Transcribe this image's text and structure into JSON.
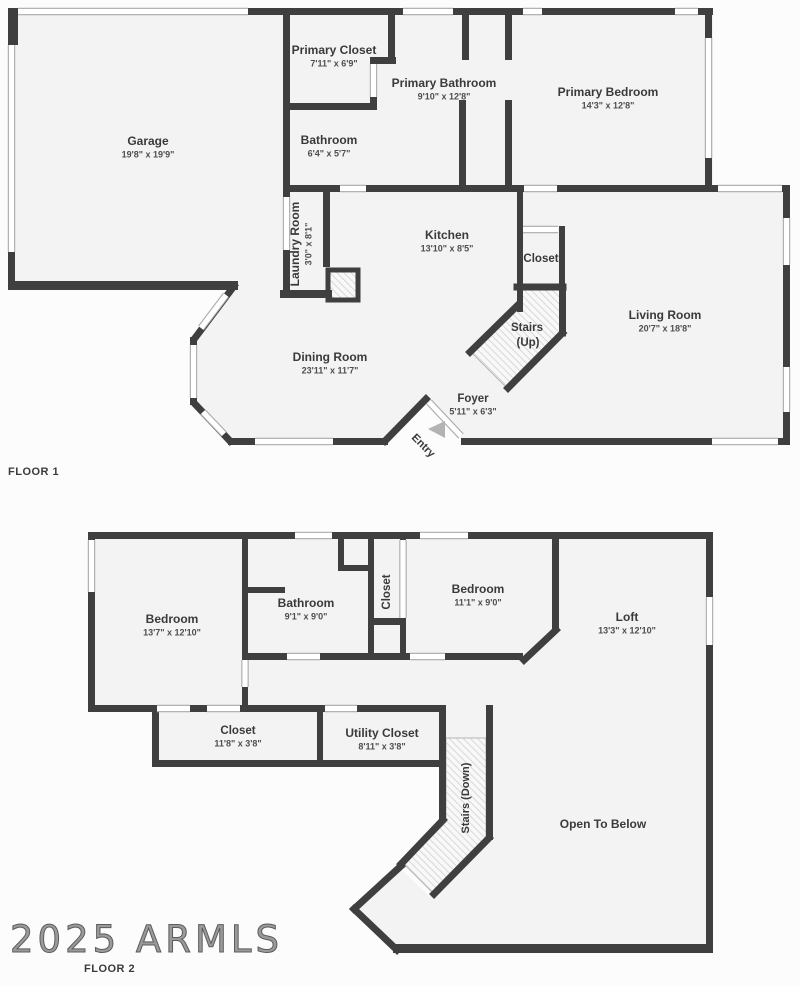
{
  "watermark": "2025 ARMLS",
  "colors": {
    "wall": "#3f3f3f",
    "room": "#f3f3f3",
    "bg": "#fcfcfc",
    "band_edge": "#a9a9a9",
    "band_fill": "#ffffff",
    "hatch_line": "#d0d0d0",
    "hatch_bg": "#f8f8f8",
    "text": "#3a3a3a",
    "dims": "#4e4e4e",
    "arrow": "#b3b3b3"
  },
  "floor1": {
    "label": "FLOOR 1",
    "rooms": [
      {
        "id": "garage",
        "name": "Garage",
        "dims": "19'8\" x 19'9\"",
        "x": 148,
        "y": 142
      },
      {
        "id": "primary-closet",
        "name": "Primary Closet",
        "dims": "7'11\" x 6'9\"",
        "x": 334,
        "y": 51
      },
      {
        "id": "primary-bathroom",
        "name": "Primary Bathroom",
        "dims": "9'10\" x 12'8\"",
        "x": 444,
        "y": 84
      },
      {
        "id": "primary-bedroom",
        "name": "Primary Bedroom",
        "dims": "14'3\" x 12'8\"",
        "x": 608,
        "y": 93
      },
      {
        "id": "bathroom-1",
        "name": "Bathroom",
        "dims": "6'4\" x 5'7\"",
        "x": 329,
        "y": 141
      },
      {
        "id": "laundry-room",
        "name": "Laundry Room",
        "dims": "3'0\" x 8'1\"",
        "x": 296,
        "y": 244,
        "rot": -90
      },
      {
        "id": "kitchen",
        "name": "Kitchen",
        "dims": "13'10\" x 8'5\"",
        "x": 447,
        "y": 236
      },
      {
        "id": "closet-f1",
        "name": "Closet",
        "x": 541,
        "y": 259,
        "fs": 11.5
      },
      {
        "id": "stairs-up",
        "name": "Stairs",
        "name2": "(Up)",
        "x": 527,
        "y": 328,
        "fs": 11.5
      },
      {
        "id": "living-room",
        "name": "Living Room",
        "dims": "20'7\" x 18'8\"",
        "x": 665,
        "y": 316
      },
      {
        "id": "dining-room",
        "name": "Dining Room",
        "dims": "23'11\" x 11'7\"",
        "x": 330,
        "y": 358
      },
      {
        "id": "foyer",
        "name": "Foyer",
        "dims": "5'11\" x 6'3\"",
        "x": 473,
        "y": 399,
        "fs": 11.5
      },
      {
        "id": "entry",
        "name": "Entry",
        "x": 423,
        "y": 446,
        "rot": 45,
        "fs": 11
      }
    ]
  },
  "floor2": {
    "label": "FLOOR 2",
    "rooms": [
      {
        "id": "bedroom-1",
        "name": "Bedroom",
        "dims": "13'7\" x 12'10\"",
        "x": 172,
        "y": 620
      },
      {
        "id": "bathroom-2",
        "name": "Bathroom",
        "dims": "9'1\" x 9'0\"",
        "x": 306,
        "y": 604
      },
      {
        "id": "closet-col",
        "name": "Closet",
        "x": 387,
        "y": 592,
        "rot": -90,
        "fs": 11.5
      },
      {
        "id": "bedroom-2",
        "name": "Bedroom",
        "dims": "11'1\" x 9'0\"",
        "x": 478,
        "y": 590
      },
      {
        "id": "loft",
        "name": "Loft",
        "dims": "13'3\" x 12'10\"",
        "x": 627,
        "y": 618
      },
      {
        "id": "closet-row",
        "name": "Closet",
        "dims": "11'8\" x 3'8\"",
        "x": 238,
        "y": 731,
        "fs": 11.5
      },
      {
        "id": "utility-closet",
        "name": "Utility Closet",
        "dims": "8'11\" x 3'8\"",
        "x": 382,
        "y": 734
      },
      {
        "id": "stairs-down",
        "name": "Stairs (Down)",
        "x": 466,
        "y": 798,
        "rot": -90,
        "fs": 11
      },
      {
        "id": "open-to-below",
        "name": "Open To Below",
        "x": 603,
        "y": 825
      }
    ]
  },
  "geometry": {
    "interiors": [
      {
        "pts": [
          [
            8,
            8
          ],
          [
            290,
            8
          ],
          [
            290,
            290
          ],
          [
            8,
            290
          ]
        ]
      },
      {
        "pts": [
          [
            283,
            8
          ],
          [
            713,
            8
          ],
          [
            713,
            192
          ],
          [
            283,
            192
          ]
        ]
      },
      {
        "pts": [
          [
            558,
            185
          ],
          [
            790,
            185
          ],
          [
            790,
            445
          ],
          [
            558,
            445
          ]
        ]
      },
      {
        "pts": [
          [
            280,
            185
          ],
          [
            558,
            185
          ],
          [
            558,
            441
          ],
          [
            463,
            441
          ],
          [
            426,
            400
          ],
          [
            385,
            441
          ],
          [
            231,
            441
          ],
          [
            196,
            404
          ],
          [
            193,
            339
          ],
          [
            236,
            285
          ],
          [
            280,
            285
          ]
        ]
      },
      {
        "pts": [
          [
            88,
            532
          ],
          [
            713,
            532
          ],
          [
            713,
            712
          ],
          [
            88,
            712
          ]
        ]
      },
      {
        "pts": [
          [
            152,
            705
          ],
          [
            446,
            705
          ],
          [
            446,
            767
          ],
          [
            152,
            767
          ]
        ]
      },
      {
        "pts": [
          [
            439,
            705
          ],
          [
            493,
            705
          ],
          [
            493,
            745
          ],
          [
            439,
            745
          ]
        ]
      },
      {
        "pts": [
          [
            493,
            712
          ],
          [
            713,
            712
          ],
          [
            713,
            946
          ],
          [
            398,
            946
          ],
          [
            355,
            909
          ],
          [
            400,
            868
          ],
          [
            430,
            897
          ],
          [
            487,
            841
          ],
          [
            493,
            834
          ]
        ]
      }
    ],
    "stairs": [
      {
        "pts": [
          [
            519,
            289
          ],
          [
            561,
            289
          ],
          [
            561,
            332
          ],
          [
            506,
            387
          ],
          [
            471,
            352
          ],
          [
            519,
            305
          ]
        ]
      },
      {
        "pts": [
          [
            446,
            738
          ],
          [
            486,
            738
          ],
          [
            486,
            838
          ],
          [
            432,
            892
          ],
          [
            404,
            864
          ],
          [
            446,
            822
          ]
        ]
      }
    ],
    "hatchboxes": [
      {
        "x": 328,
        "y": 270,
        "w": 30,
        "h": 30
      }
    ],
    "walls_rect": [
      {
        "x": 8,
        "y": 8,
        "w": 10,
        "h": 37
      },
      {
        "x": 248,
        "y": 8,
        "w": 42,
        "h": 7
      },
      {
        "x": 8,
        "y": 252,
        "w": 7,
        "h": 38
      },
      {
        "x": 8,
        "y": 281,
        "w": 230,
        "h": 9
      },
      {
        "x": 283,
        "y": 8,
        "w": 7,
        "h": 189
      },
      {
        "x": 283,
        "y": 250,
        "w": 7,
        "h": 48
      },
      {
        "x": 283,
        "y": 8,
        "w": 430,
        "h": 7
      },
      {
        "x": 388,
        "y": 8,
        "w": 7,
        "h": 52
      },
      {
        "x": 370,
        "y": 57,
        "w": 26,
        "h": 7
      },
      {
        "x": 370,
        "y": 97,
        "w": 7,
        "h": 13
      },
      {
        "x": 283,
        "y": 103,
        "w": 90,
        "h": 7
      },
      {
        "x": 283,
        "y": 185,
        "w": 57,
        "h": 7
      },
      {
        "x": 366,
        "y": 185,
        "w": 158,
        "h": 7
      },
      {
        "x": 557,
        "y": 185,
        "w": 233,
        "h": 7
      },
      {
        "x": 462,
        "y": 12,
        "w": 7,
        "h": 48
      },
      {
        "x": 459,
        "y": 100,
        "w": 7,
        "h": 85
      },
      {
        "x": 505,
        "y": 12,
        "w": 7,
        "h": 48
      },
      {
        "x": 505,
        "y": 100,
        "w": 7,
        "h": 85
      },
      {
        "x": 705,
        "y": 8,
        "w": 7,
        "h": 30
      },
      {
        "x": 705,
        "y": 158,
        "w": 7,
        "h": 34
      },
      {
        "x": 783,
        "y": 185,
        "w": 7,
        "h": 33
      },
      {
        "x": 783,
        "y": 265,
        "w": 7,
        "h": 102
      },
      {
        "x": 783,
        "y": 412,
        "w": 7,
        "h": 33
      },
      {
        "x": 461,
        "y": 438,
        "w": 329,
        "h": 7
      },
      {
        "x": 517,
        "y": 185,
        "w": 6,
        "h": 127
      },
      {
        "x": 559,
        "y": 226,
        "w": 6,
        "h": 64
      },
      {
        "x": 323,
        "y": 185,
        "w": 7,
        "h": 82
      },
      {
        "x": 280,
        "y": 290,
        "w": 52,
        "h": 8
      },
      {
        "x": 228,
        "y": 438,
        "w": 160,
        "h": 7
      },
      {
        "x": 190,
        "y": 337,
        "w": 7,
        "h": 68
      },
      {
        "x": 88,
        "y": 532,
        "w": 625,
        "h": 7
      },
      {
        "x": 88,
        "y": 532,
        "w": 7,
        "h": 180
      },
      {
        "x": 88,
        "y": 705,
        "w": 69,
        "h": 7
      },
      {
        "x": 190,
        "y": 705,
        "w": 17,
        "h": 7
      },
      {
        "x": 240,
        "y": 705,
        "w": 85,
        "h": 7
      },
      {
        "x": 357,
        "y": 705,
        "w": 89,
        "h": 7
      },
      {
        "x": 242,
        "y": 532,
        "w": 6,
        "h": 128
      },
      {
        "x": 242,
        "y": 687,
        "w": 6,
        "h": 25
      },
      {
        "x": 248,
        "y": 587,
        "w": 37,
        "h": 6
      },
      {
        "x": 338,
        "y": 539,
        "w": 6,
        "h": 29
      },
      {
        "x": 338,
        "y": 565,
        "w": 34,
        "h": 6
      },
      {
        "x": 242,
        "y": 653,
        "w": 45,
        "h": 7
      },
      {
        "x": 320,
        "y": 653,
        "w": 90,
        "h": 7
      },
      {
        "x": 445,
        "y": 653,
        "w": 78,
        "h": 7
      },
      {
        "x": 368,
        "y": 532,
        "w": 6,
        "h": 128
      },
      {
        "x": 400,
        "y": 532,
        "w": 6,
        "h": 8
      },
      {
        "x": 400,
        "y": 618,
        "w": 6,
        "h": 42
      },
      {
        "x": 372,
        "y": 618,
        "w": 34,
        "h": 7
      },
      {
        "x": 552,
        "y": 532,
        "w": 7,
        "h": 98
      },
      {
        "x": 486,
        "y": 705,
        "w": 7,
        "h": 135
      },
      {
        "x": 706,
        "y": 532,
        "w": 7,
        "h": 65
      },
      {
        "x": 706,
        "y": 645,
        "w": 7,
        "h": 308
      },
      {
        "x": 152,
        "y": 705,
        "w": 7,
        "h": 62
      },
      {
        "x": 152,
        "y": 760,
        "w": 294,
        "h": 7
      },
      {
        "x": 317,
        "y": 705,
        "w": 6,
        "h": 62
      },
      {
        "x": 439,
        "y": 705,
        "w": 7,
        "h": 117
      },
      {
        "x": 393,
        "y": 944,
        "w": 320,
        "h": 9
      }
    ],
    "walls_line": [
      {
        "x1": 234,
        "y1": 286,
        "x2": 195,
        "y2": 338
      },
      {
        "x1": 195,
        "y1": 404,
        "x2": 230,
        "y2": 441
      },
      {
        "x1": 385,
        "y1": 441,
        "x2": 426,
        "y2": 399
      },
      {
        "x1": 517,
        "y1": 287,
        "x2": 563,
        "y2": 287
      },
      {
        "x1": 517,
        "y1": 306,
        "x2": 470,
        "y2": 352
      },
      {
        "x1": 562.5,
        "y1": 288,
        "x2": 562.5,
        "y2": 333
      },
      {
        "x1": 562.5,
        "y1": 333,
        "x2": 508,
        "y2": 388
      },
      {
        "x1": 556,
        "y1": 630,
        "x2": 524,
        "y2": 660
      },
      {
        "x1": 443,
        "y1": 820,
        "x2": 401,
        "y2": 864
      },
      {
        "x1": 489,
        "y1": 838,
        "x2": 434,
        "y2": 894
      },
      {
        "x1": 401,
        "y1": 866,
        "x2": 354,
        "y2": 909
      },
      {
        "x1": 354,
        "y1": 909,
        "x2": 397,
        "y2": 950
      }
    ],
    "bands": [
      {
        "x1": 18,
        "y1": 11.5,
        "x2": 248,
        "y2": 11.5
      },
      {
        "x1": 11.5,
        "y1": 45,
        "x2": 11.5,
        "y2": 252
      },
      {
        "x1": 403,
        "y1": 11.5,
        "x2": 453,
        "y2": 11.5
      },
      {
        "x1": 523,
        "y1": 11.5,
        "x2": 542,
        "y2": 11.5
      },
      {
        "x1": 675,
        "y1": 11.5,
        "x2": 698,
        "y2": 11.5
      },
      {
        "x1": 373.5,
        "y1": 64,
        "x2": 373.5,
        "y2": 97
      },
      {
        "x1": 286.5,
        "y1": 197,
        "x2": 286.5,
        "y2": 250
      },
      {
        "x1": 340,
        "y1": 188.5,
        "x2": 366,
        "y2": 188.5
      },
      {
        "x1": 524,
        "y1": 188.5,
        "x2": 557,
        "y2": 188.5
      },
      {
        "x1": 718,
        "y1": 188.5,
        "x2": 782,
        "y2": 188.5
      },
      {
        "x1": 708.5,
        "y1": 38,
        "x2": 708.5,
        "y2": 158
      },
      {
        "x1": 786.5,
        "y1": 218,
        "x2": 786.5,
        "y2": 265
      },
      {
        "x1": 786.5,
        "y1": 367,
        "x2": 786.5,
        "y2": 412
      },
      {
        "x1": 712,
        "y1": 441.5,
        "x2": 778,
        "y2": 441.5
      },
      {
        "x1": 255,
        "y1": 441.5,
        "x2": 333,
        "y2": 441.5
      },
      {
        "x1": 193.5,
        "y1": 345,
        "x2": 193.5,
        "y2": 398
      },
      {
        "x1": 226,
        "y1": 295,
        "x2": 201,
        "y2": 328
      },
      {
        "x1": 203,
        "y1": 412,
        "x2": 224,
        "y2": 434
      },
      {
        "x1": 429,
        "y1": 402,
        "x2": 461,
        "y2": 436
      },
      {
        "x1": 523,
        "y1": 229.5,
        "x2": 558,
        "y2": 229.5
      },
      {
        "x1": 295,
        "y1": 535.5,
        "x2": 332,
        "y2": 535.5
      },
      {
        "x1": 420,
        "y1": 535.5,
        "x2": 468,
        "y2": 535.5
      },
      {
        "x1": 91.5,
        "y1": 540,
        "x2": 91.5,
        "y2": 592
      },
      {
        "x1": 157,
        "y1": 708.5,
        "x2": 190,
        "y2": 708.5
      },
      {
        "x1": 207,
        "y1": 708.5,
        "x2": 240,
        "y2": 708.5
      },
      {
        "x1": 325,
        "y1": 708.5,
        "x2": 357,
        "y2": 708.5
      },
      {
        "x1": 245,
        "y1": 660,
        "x2": 245,
        "y2": 687
      },
      {
        "x1": 287,
        "y1": 656.5,
        "x2": 320,
        "y2": 656.5
      },
      {
        "x1": 410,
        "y1": 656.5,
        "x2": 445,
        "y2": 656.5
      },
      {
        "x1": 403,
        "y1": 540,
        "x2": 403,
        "y2": 618
      },
      {
        "x1": 709.5,
        "y1": 597,
        "x2": 709.5,
        "y2": 645
      }
    ],
    "entry_arrow": [
      [
        428,
        429
      ],
      [
        445,
        421
      ],
      [
        445,
        438
      ]
    ]
  }
}
